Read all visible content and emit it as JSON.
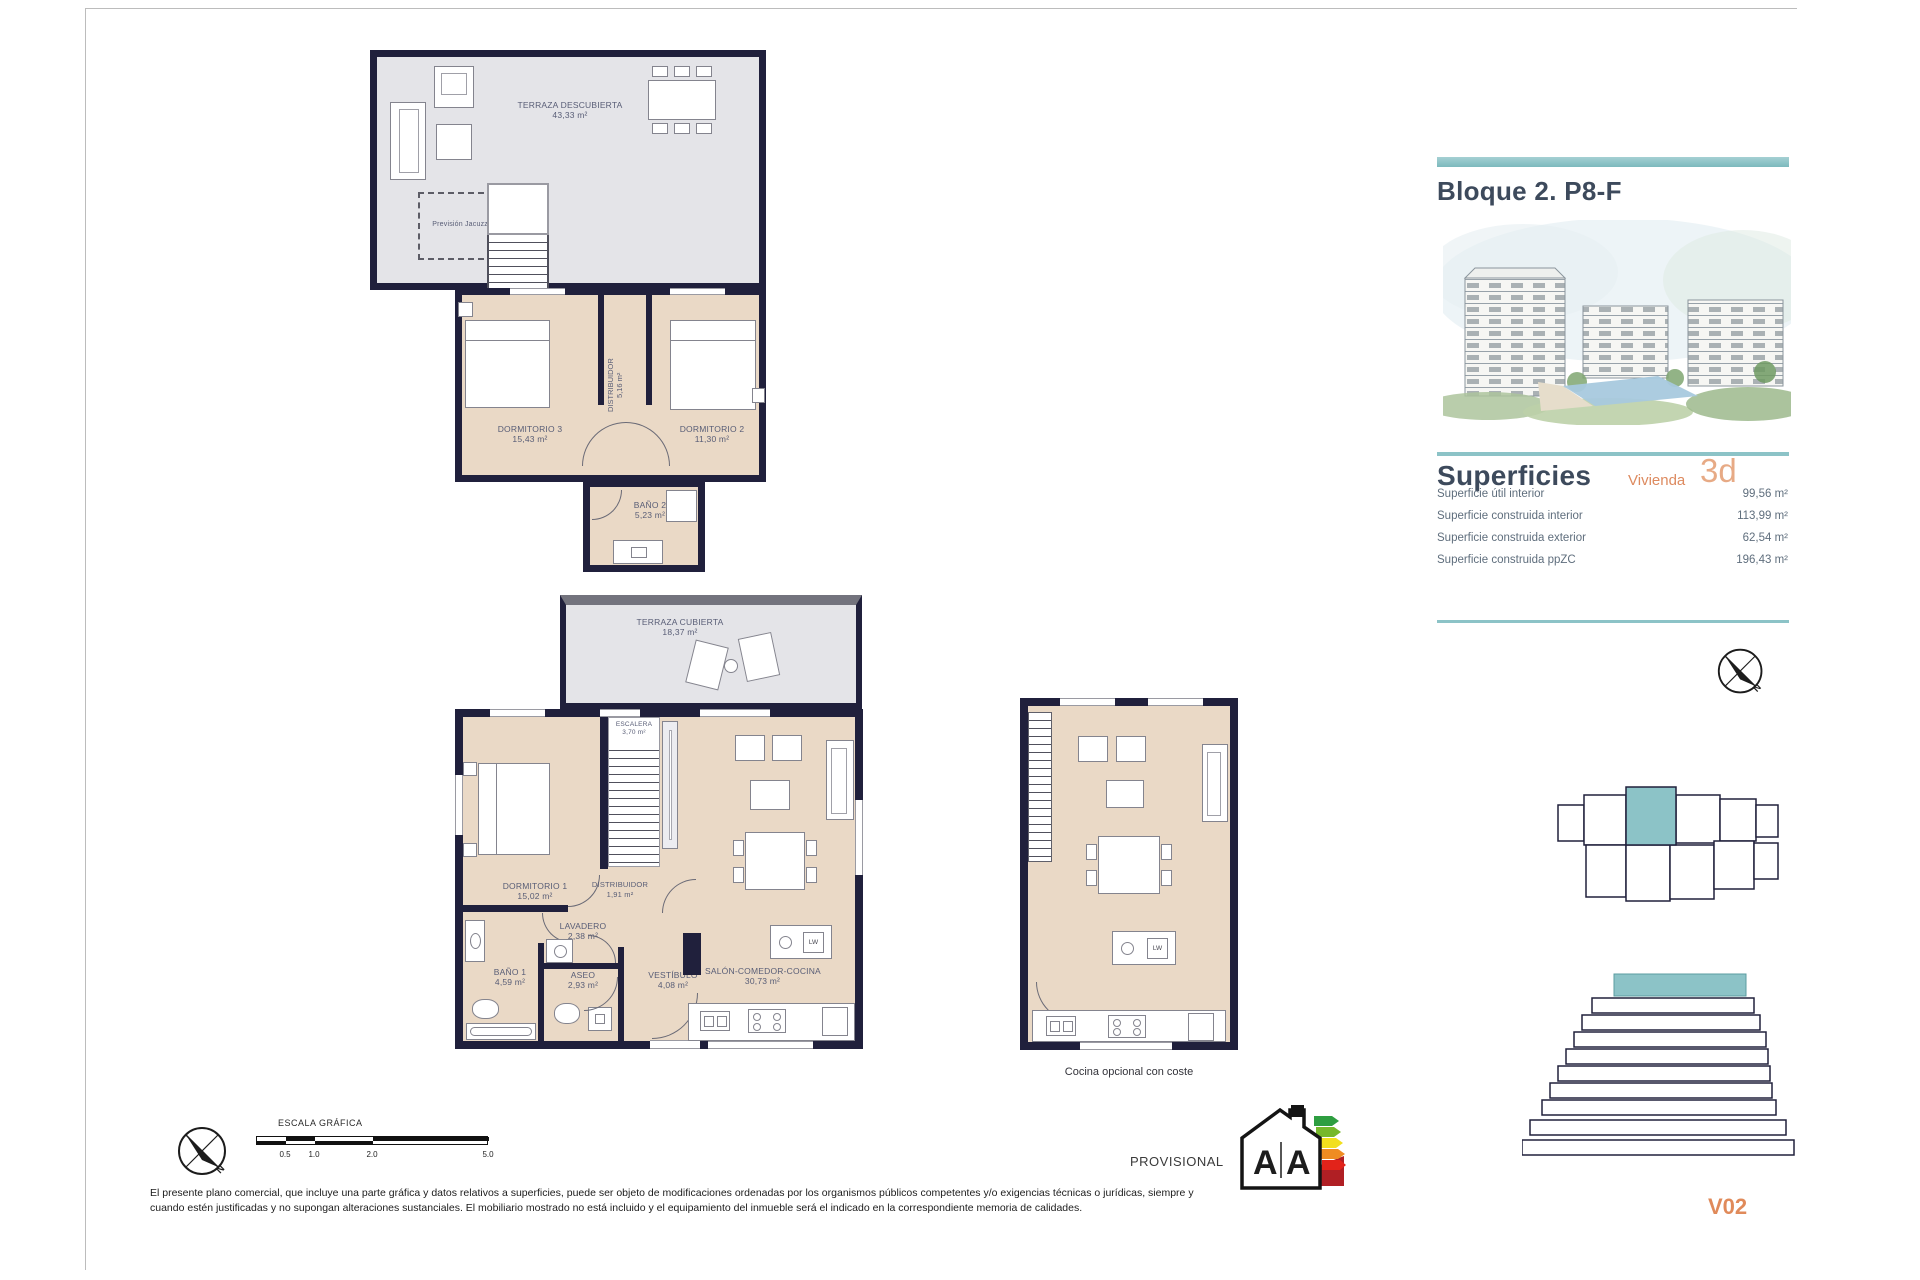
{
  "colors": {
    "teal": "#8cc3c7",
    "orange": "#dd8a5f",
    "orange_light": "#e7aa85",
    "wall_navy": "#20203c",
    "floor_beige": "#ead9c6",
    "floor_gray": "#e4e4e8",
    "title_navy": "#3d4a5c"
  },
  "sidebar": {
    "title": "Bloque 2. P8-F",
    "superficies": {
      "heading": "Superficies",
      "unit_label": "Vivienda",
      "unit_type": "3d",
      "rows": [
        {
          "label": "Superficie útil interior",
          "value": "99,56 m²"
        },
        {
          "label": "Superficie construida interior",
          "value": "113,99 m²"
        },
        {
          "label": "Superficie construida exterior",
          "value": "62,54 m²"
        },
        {
          "label": "Superficie construida ppZC",
          "value": "196,43 m²"
        }
      ]
    },
    "version": "V02"
  },
  "plans": {
    "upper": {
      "terraza": {
        "name": "TERRAZA DESCUBIERTA",
        "area": "43,33 m²"
      },
      "jacuzzi_label": "Previsión Jacuzzi",
      "dormitorio3": {
        "name": "DORMITORIO 3",
        "area": "15,43 m²"
      },
      "dormitorio2": {
        "name": "DORMITORIO 2",
        "area": "11,30 m²"
      },
      "distribuidor": {
        "name": "DISTRIBUIDOR",
        "area": "5,16 m²"
      },
      "bano2": {
        "name": "BAÑO 2",
        "area": "5,23 m²"
      }
    },
    "main": {
      "terraza": {
        "name": "TERRAZA CUBIERTA",
        "area": "18,37 m²"
      },
      "escalera": {
        "name": "ESCALERA",
        "area": "3,70 m²"
      },
      "dormitorio1": {
        "name": "DORMITORIO 1",
        "area": "15,02 m²"
      },
      "distribuidor": {
        "name": "DISTRIBUIDOR",
        "area": "1,91 m²"
      },
      "lavadero": {
        "name": "LAVADERO",
        "area": "2,38 m²"
      },
      "bano1": {
        "name": "BAÑO 1",
        "area": "4,59 m²"
      },
      "aseo": {
        "name": "ASEO",
        "area": "2,93 m²"
      },
      "vestibulo": {
        "name": "VESTÍBULO",
        "area": "4,08 m²"
      },
      "salon": {
        "name": "SALÓN-COMEDOR-COCINA",
        "area": "30,73 m²"
      },
      "appliance": "LW"
    },
    "option": {
      "caption": "Cocina opcional con coste",
      "appliance": "LW"
    }
  },
  "footer": {
    "north": "N",
    "escala_label": "ESCALA GRÁFICA",
    "scale_ticks": [
      "0.5",
      "1.0",
      "2.0",
      "5.0"
    ],
    "provisional": "PROVISIONAL",
    "energy_letter_left": "A",
    "energy_letter_right": "A",
    "disclaimer_line1": "El presente plano comercial, que incluye una parte gráfica y datos relativos a superficies, puede ser objeto de modificaciones ordenadas por los organismos públicos competentes y/o exigencias técnicas o jurídicas, siempre y",
    "disclaimer_line2": "cuando estén justificadas y no supongan alteraciones sustanciales. El mobiliario mostrado no está incluido y el equipamiento del inmueble será el indicado en la correspondiente memoria de calidades."
  }
}
